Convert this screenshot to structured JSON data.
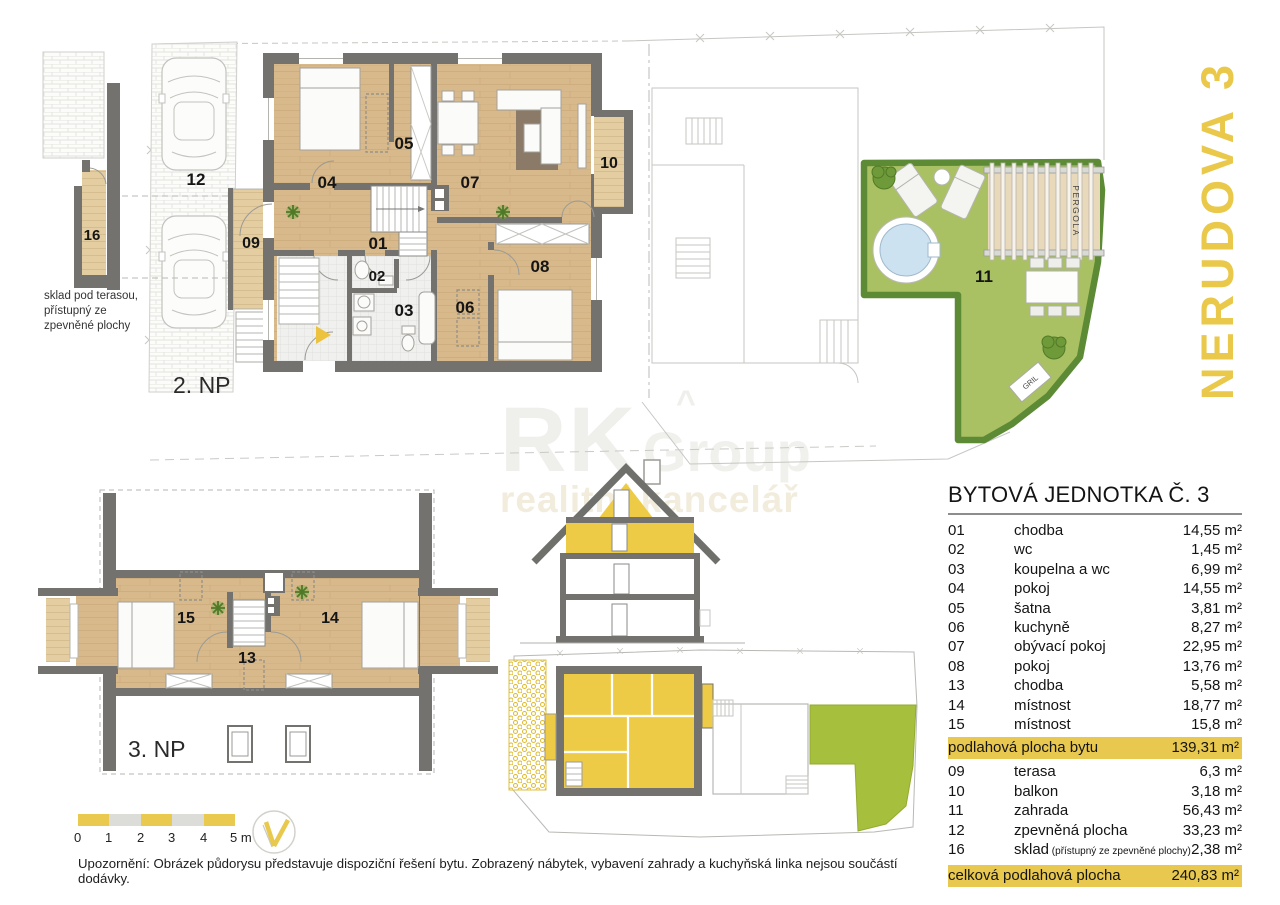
{
  "title_vertical": "NERUDOVA 3",
  "watermark": {
    "rk": "RK",
    "group": "Group",
    "caret": "^",
    "sub": "realitní kancelář"
  },
  "plans": {
    "floor2_label": "2. NP",
    "floor3_label": "3. NP",
    "storage_note_lines": [
      "sklad pod terasou,",
      "přístupný ze",
      "zpevněné plochy"
    ],
    "pergola": "PERGOLA",
    "grill": "GRIL",
    "room_labels": {
      "n01": "01",
      "n02": "02",
      "n03": "03",
      "n04": "04",
      "n05": "05",
      "n06": "06",
      "n07": "07",
      "n08": "08",
      "n09": "09",
      "n10": "10",
      "n11": "11",
      "n12": "12",
      "n13": "13",
      "n14": "14",
      "n15": "15",
      "n16": "16"
    }
  },
  "table": {
    "title": "BYTOVÁ JEDNOTKA Č. 3",
    "interior_rows": [
      {
        "num": "01",
        "name": "chodba",
        "area": "14,55 m²"
      },
      {
        "num": "02",
        "name": "wc",
        "area": "1,45 m²"
      },
      {
        "num": "03",
        "name": "koupelna a wc",
        "area": "6,99 m²"
      },
      {
        "num": "04",
        "name": "pokoj",
        "area": "14,55 m²"
      },
      {
        "num": "05",
        "name": "šatna",
        "area": "3,81 m²"
      },
      {
        "num": "06",
        "name": "kuchyně",
        "area": "8,27 m²"
      },
      {
        "num": "07",
        "name": "obývací pokoj",
        "area": "22,95 m²"
      },
      {
        "num": "08",
        "name": "pokoj",
        "area": "13,76 m²"
      },
      {
        "num": "13",
        "name": "chodba",
        "area": "5,58 m²"
      },
      {
        "num": "14",
        "name": "místnost",
        "area": "18,77 m²"
      },
      {
        "num": "15",
        "name": "místnost",
        "area": "15,8 m²"
      }
    ],
    "subtotal": {
      "label": "podlahová plocha bytu",
      "area": "139,31 m²"
    },
    "exterior_rows": [
      {
        "num": "09",
        "name": "terasa",
        "area": "6,3 m²"
      },
      {
        "num": "10",
        "name": "balkon",
        "area": "3,18 m²"
      },
      {
        "num": "11",
        "name": "zahrada",
        "area": "56,43 m²"
      },
      {
        "num": "12",
        "name": "zpevněná plocha",
        "area": "33,23 m²"
      },
      {
        "num": "16",
        "name": "sklad",
        "note": "(přístupný ze zpevněné plochy)",
        "area": "2,38 m²"
      }
    ],
    "total": {
      "label": "celková podlahová plocha",
      "area": "240,83 m²"
    }
  },
  "scalebar": {
    "labels": [
      "0",
      "1",
      "2",
      "3",
      "4",
      "5 m"
    ]
  },
  "disclaimer": "Upozornění: Obrázek půdorysu představuje dispoziční řešení bytu. Zobrazený nábytek, vybavení zahrady a kuchyňská linka nejsou součástí dodávky.",
  "colors": {
    "accent_yellow": "#e9c84e",
    "highlight_row": "#e8c84e",
    "wall_gray": "#73726e",
    "wood_floor": "#d8b98b",
    "deck_wood": "#e4cda1",
    "grass_green": "#a9c163",
    "hedge_green": "#5d8a35",
    "pool_blue": "#cde2f1",
    "section_yellow": "#eecb47",
    "site_green": "#a6bf3c"
  }
}
